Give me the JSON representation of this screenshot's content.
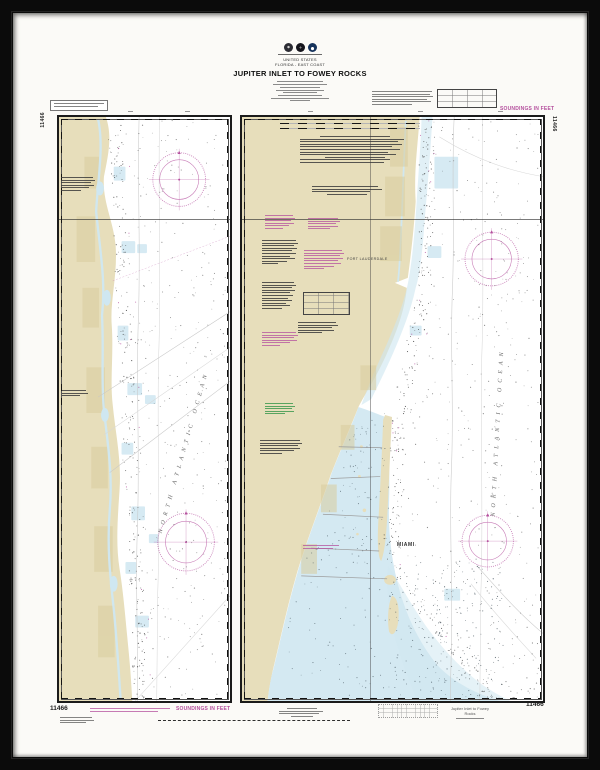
{
  "colors": {
    "magenta": "#b44f9d",
    "green": "#3f9a50",
    "land": "#e7debb",
    "landdk": "#d9cd9e",
    "shallow": "#cfe7f1"
  },
  "header": {
    "seal_icons": [
      "commerce-seal",
      "survey-seal",
      "noaa-seal"
    ],
    "agency_line": "UNITED STATES",
    "region_line": "FLORIDA - EAST COAST",
    "title": "JUPITER INLET TO FOWEY ROCKS"
  },
  "chart": {
    "left_panel": {
      "ocean_label": "NORTH ATLANTIC OCEAN"
    },
    "right_panel": {
      "ocean_label": "NORTH ATLANTIC OCEAN",
      "city1": "FORT LAUDERDALE",
      "city2": "MIAMI"
    }
  },
  "margins": {
    "soundings_top": "SOUNDINGS IN FEET",
    "soundings_bottom": "SOUNDINGS IN FEET",
    "number": "11466",
    "caption": "Jupiter Inlet to Fowey Rocks"
  }
}
